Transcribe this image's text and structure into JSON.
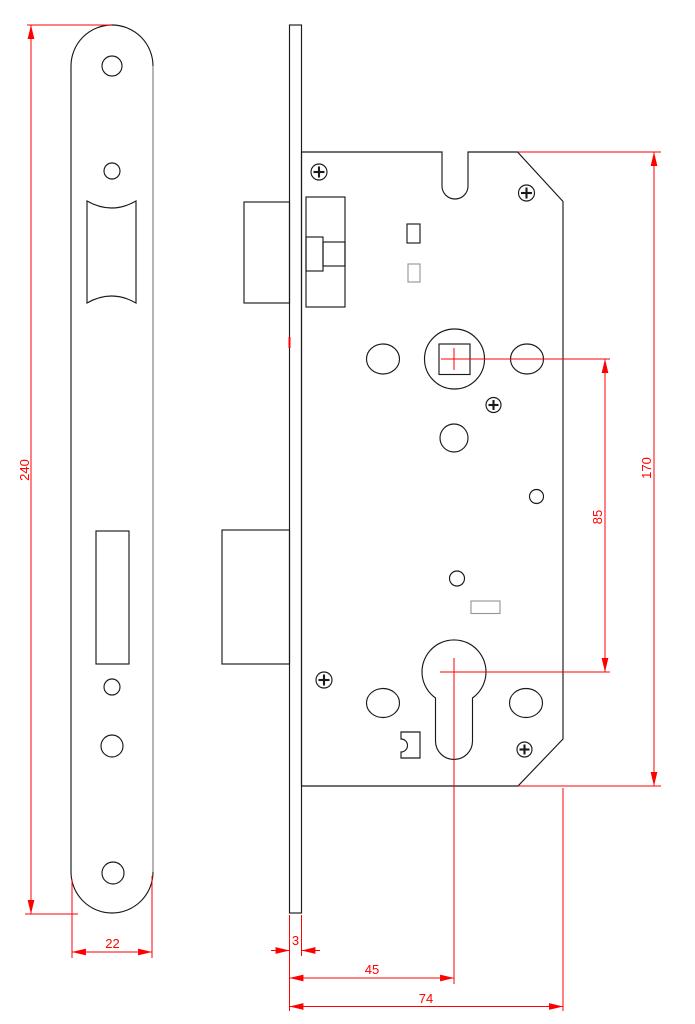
{
  "drawing": {
    "colors": {
      "outline": "#1a1a1a",
      "secondary": "#979797",
      "dimension": "#ff0000",
      "background": "#ffffff"
    },
    "dims": {
      "plate_height": "240",
      "plate_width": "22",
      "faceplate_thickness": "3",
      "backset": "45",
      "case_depth": "74",
      "case_height": "170",
      "centre_distance": "85"
    }
  }
}
